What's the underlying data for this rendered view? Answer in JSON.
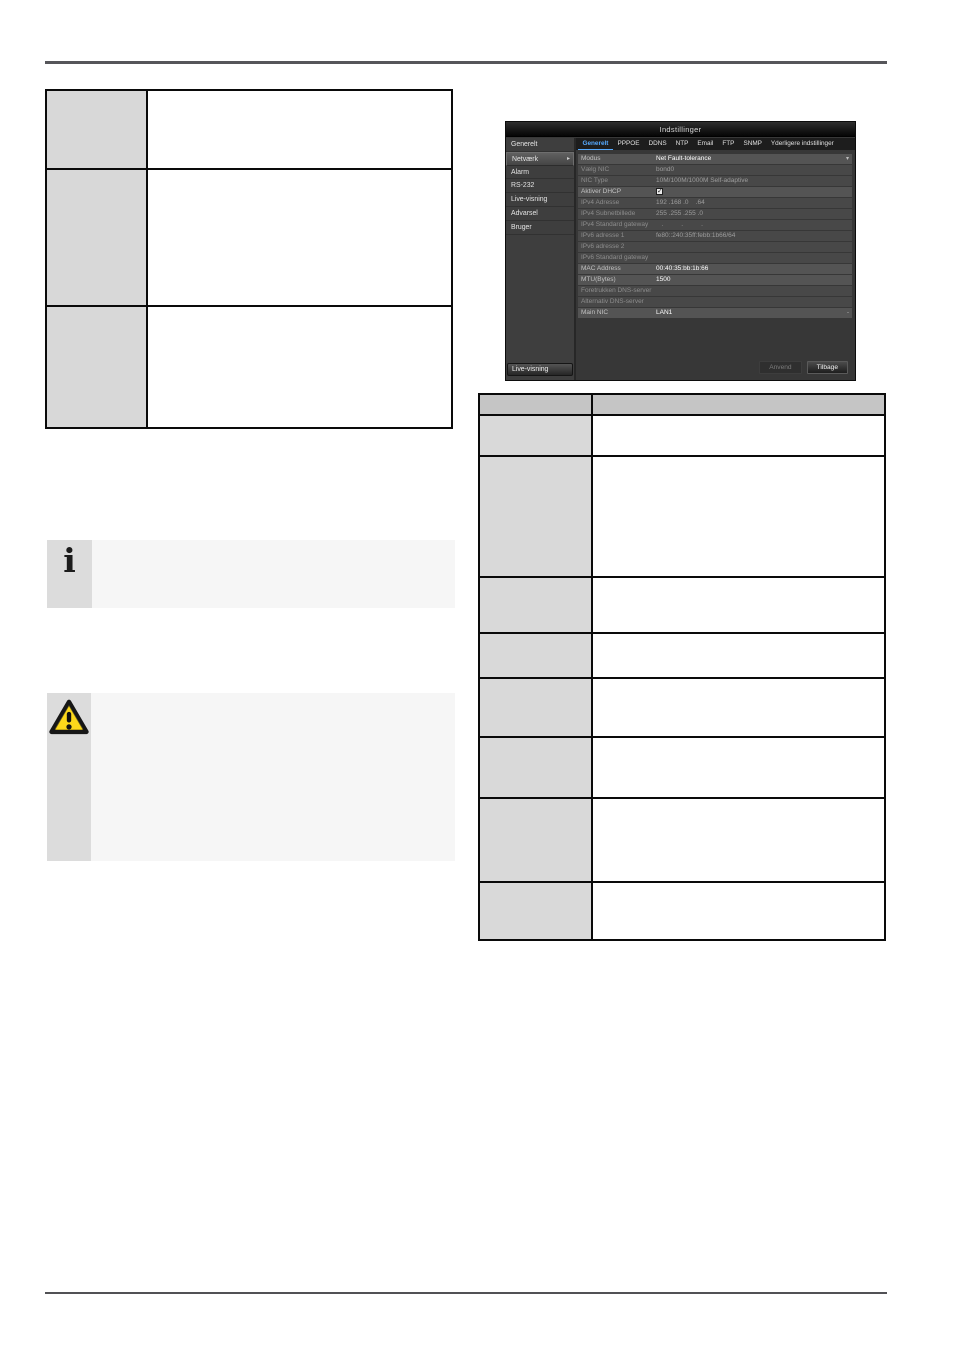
{
  "colors": {
    "accent_tab_blue": "#56aaff",
    "warning_yellow": "#ffd60a",
    "dialog_bg": "#383838",
    "table_header_gray": "#c5c5c5",
    "table_label_gray": "#d9d9d9"
  },
  "icons": {
    "info": "i",
    "warning": "warning-triangle"
  },
  "info_note": {
    "text": ""
  },
  "warning_note": {
    "text": ""
  },
  "left_table": {
    "rows": [
      {
        "label": "",
        "content": ""
      },
      {
        "label": "",
        "content": ""
      },
      {
        "label": "",
        "content": ""
      }
    ]
  },
  "right_table": {
    "header": {
      "col1": "",
      "col2": ""
    },
    "rows": [
      {
        "label": "",
        "content": ""
      },
      {
        "label": "",
        "content": ""
      },
      {
        "label": "",
        "content": ""
      },
      {
        "label": "",
        "content": ""
      },
      {
        "label": "",
        "content": ""
      },
      {
        "label": "",
        "content": ""
      },
      {
        "label": "",
        "content": ""
      },
      {
        "label": "",
        "content": ""
      }
    ]
  },
  "dialog": {
    "title": "Indstillinger",
    "sidebar": {
      "items": [
        {
          "label": "Generelt",
          "selected": false
        },
        {
          "label": "Netværk",
          "selected": true
        },
        {
          "label": "Alarm",
          "selected": false
        },
        {
          "label": "RS-232",
          "selected": false
        },
        {
          "label": "Live-visning",
          "selected": false
        },
        {
          "label": "Advarsel",
          "selected": false
        },
        {
          "label": "Bruger",
          "selected": false
        }
      ],
      "footer": "Live-visning"
    },
    "tabs": [
      {
        "label": "Generelt",
        "active": true
      },
      {
        "label": "PPPOE",
        "active": false
      },
      {
        "label": "DDNS",
        "active": false
      },
      {
        "label": "NTP",
        "active": false
      },
      {
        "label": "Email",
        "active": false
      },
      {
        "label": "FTP",
        "active": false
      },
      {
        "label": "SNMP",
        "active": false
      },
      {
        "label": "Yderligere indstillinger",
        "active": false
      }
    ],
    "form_rows": [
      {
        "label": "Modus",
        "value": "Net Fault-tolerance",
        "enabled": true,
        "marker": "▾"
      },
      {
        "label": "Vælg NIC",
        "value": "bond0",
        "enabled": false
      },
      {
        "label": "NIC Type",
        "value": "10M/100M/1000M Self-adaptive",
        "enabled": false
      },
      {
        "label": "Aktiver DHCP",
        "value": "",
        "enabled": true,
        "type": "checkbox",
        "checked": true
      },
      {
        "label": "IPv4 Adresse",
        "value": "192 .168 .0    .64",
        "enabled": false
      },
      {
        "label": "IPv4 Subnetbillede",
        "value": "255 .255 .255 .0",
        "enabled": false
      },
      {
        "label": "IPv4 Standard gateway",
        "value": "   .          .          .",
        "enabled": false
      },
      {
        "label": "IPv6 adresse 1",
        "value": "fe80::240:35ff:febb:1b66/64",
        "enabled": false
      },
      {
        "label": "IPv6 adresse 2",
        "value": "",
        "enabled": false
      },
      {
        "label": "IPv6 Standard gateway",
        "value": "",
        "enabled": false
      },
      {
        "label": "MAC Address",
        "value": "00:40:35:bb:1b:66",
        "enabled": true
      },
      {
        "label": "MTU(Bytes)",
        "value": "1500",
        "enabled": true
      },
      {
        "label": "Foretrukken DNS-server",
        "value": "",
        "enabled": false
      },
      {
        "label": "Alternativ DNS-server",
        "value": "",
        "enabled": false
      },
      {
        "label": "Main NIC",
        "value": "LAN1",
        "enabled": true,
        "marker": "-"
      }
    ],
    "buttons": [
      {
        "label": "Anvend",
        "enabled": false
      },
      {
        "label": "Tilbage",
        "enabled": true
      }
    ]
  }
}
